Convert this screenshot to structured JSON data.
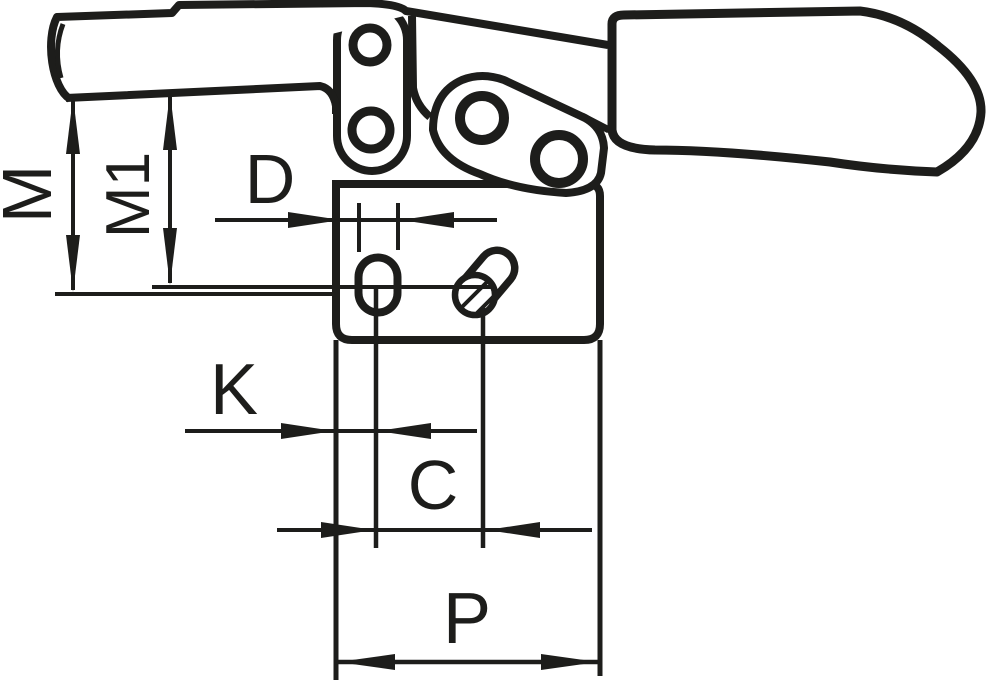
{
  "drawing": {
    "title": "horizontal-toggle-clamp-dimension-drawing",
    "labels": {
      "m": "M",
      "m1": "M1",
      "d": "D",
      "k": "K",
      "c": "C",
      "p": "P"
    },
    "colors": {
      "ink": "#1d1d1b",
      "paper": "#ffffff"
    }
  }
}
